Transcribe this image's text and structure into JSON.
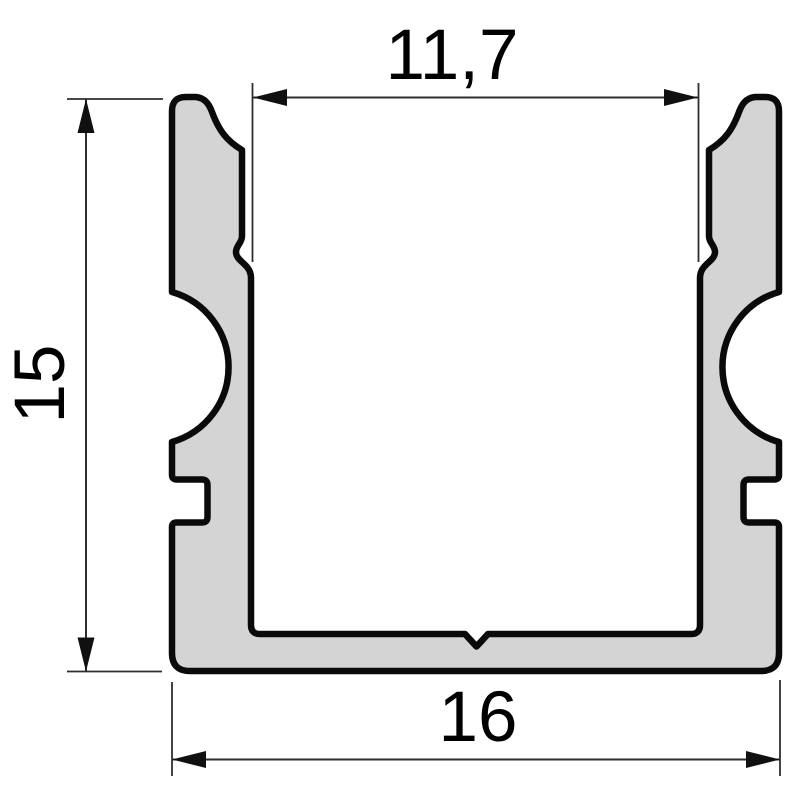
{
  "drawing": {
    "object": "u-channel-aluminium-profile-cross-section",
    "dimensions": {
      "inner_width": "11,7",
      "height": "15",
      "outer_width": "16"
    },
    "colors": {
      "background": "#ffffff",
      "profile_fill": "#d4d4d4",
      "profile_outline": "#0a0a0a",
      "dimension_line": "#2e2e2e",
      "dimension_text": "#000000"
    }
  }
}
